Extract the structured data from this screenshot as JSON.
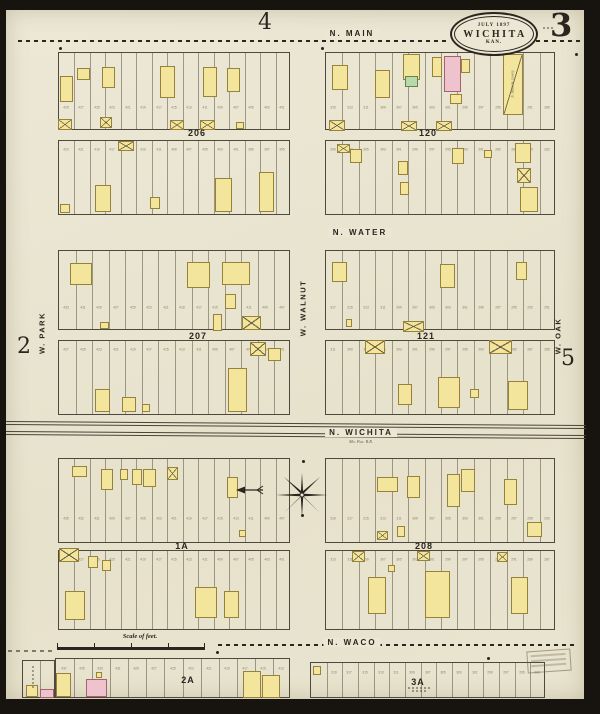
{
  "colors": {
    "paper": "#ebe7d4",
    "ink": "#2a251e",
    "frame_yellow": "#f3e59b",
    "frame_yellow_border": "#97823b",
    "brick_pink": "#eec3cd",
    "brick_pink_border": "#a2636f",
    "special_green": "#b9d9ab",
    "special_green_border": "#5f8452",
    "faint_number": "#8b8169"
  },
  "header": {
    "adjacent_top": "4",
    "sheet_number": "3",
    "title_date": "July 1897",
    "title_city": "WICHITA",
    "title_state": "KAN."
  },
  "margins": {
    "adjacent_left": "2",
    "adjacent_right": "5"
  },
  "streets": {
    "n_main": "N. MAIN",
    "n_water": "N. WATER",
    "n_wichita": "N. WICHITA",
    "n_waco": "N. WACO",
    "w_park": "W. PARK",
    "w_walnut": "W. WALNUT",
    "w_oak": "W. OAK"
  },
  "railroad": {
    "note": "Mo. Pac. R.R."
  },
  "scale": {
    "label": "Scale of feet."
  },
  "notes": {
    "livery": "N. Main St. Livery"
  },
  "blocks": [
    {
      "label": "206",
      "lx": 197,
      "ly": 128,
      "strips": [
        {
          "x": 58,
          "y": 52,
          "w": 232,
          "h": 78,
          "lots": 15,
          "ny": 0.72,
          "ns": 429,
          "b": [
            [
              60,
              76,
              13,
              26,
              "y",
              0
            ],
            [
              77,
              68,
              13,
              12,
              "y",
              0
            ],
            [
              102,
              67,
              13,
              21,
              "y",
              0
            ],
            [
              160,
              66,
              15,
              32,
              "y",
              0
            ],
            [
              203,
              67,
              14,
              30,
              "y",
              0
            ],
            [
              227,
              68,
              13,
              24,
              "y",
              0
            ],
            [
              58,
              119,
              14,
              11,
              "y",
              1
            ],
            [
              100,
              117,
              12,
              11,
              "y",
              1
            ],
            [
              170,
              120,
              14,
              10,
              "y",
              1
            ],
            [
              200,
              120,
              15,
              10,
              "y",
              1
            ],
            [
              236,
              122,
              8,
              7,
              "y",
              0
            ]
          ]
        },
        {
          "x": 58,
          "y": 140,
          "w": 232,
          "h": 75,
          "lots": 15,
          "ny": 0.13,
          "ns": 423,
          "b": [
            [
              118,
              141,
              16,
              10,
              "y",
              1
            ],
            [
              95,
              185,
              16,
              27,
              "y",
              0
            ],
            [
              150,
              197,
              10,
              12,
              "y",
              0
            ],
            [
              215,
              178,
              17,
              34,
              "y",
              0
            ],
            [
              259,
              172,
              15,
              40,
              "y",
              0
            ],
            [
              60,
              204,
              10,
              9,
              "y",
              0
            ]
          ]
        }
      ]
    },
    {
      "label": "120",
      "lx": 428,
      "ly": 128,
      "strips": [
        {
          "x": 325,
          "y": 52,
          "w": 230,
          "h": 78,
          "lots": 14,
          "ny": 0.72,
          "ns": 315,
          "b": [
            [
              332,
              65,
              16,
              25,
              "y",
              0
            ],
            [
              375,
              70,
              15,
              28,
              "y",
              0
            ],
            [
              403,
              54,
              17,
              26,
              "y",
              0
            ],
            [
              405,
              76,
              13,
              11,
              "g",
              0
            ],
            [
              432,
              57,
              10,
              20,
              "y",
              0
            ],
            [
              444,
              56,
              17,
              36,
              "p",
              0
            ],
            [
              461,
              59,
              9,
              14,
              "y",
              0
            ],
            [
              450,
              94,
              12,
              10,
              "y",
              0
            ],
            [
              503,
              54,
              20,
              61,
              "y",
              2
            ],
            [
              401,
              121,
              16,
              10,
              "y",
              1
            ],
            [
              436,
              121,
              16,
              10,
              "y",
              1
            ],
            [
              329,
              120,
              16,
              11,
              "y",
              1
            ]
          ]
        },
        {
          "x": 325,
          "y": 140,
          "w": 230,
          "h": 75,
          "lots": 14,
          "ny": 0.13,
          "ns": 309,
          "b": [
            [
              350,
              149,
              12,
              14,
              "y",
              0
            ],
            [
              398,
              161,
              10,
              14,
              "y",
              0
            ],
            [
              400,
              182,
              9,
              13,
              "y",
              0
            ],
            [
              452,
              148,
              12,
              16,
              "y",
              0
            ],
            [
              515,
              143,
              16,
              20,
              "y",
              0
            ],
            [
              517,
              168,
              14,
              15,
              "y",
              1
            ],
            [
              520,
              187,
              18,
              25,
              "y",
              0
            ],
            [
              484,
              150,
              8,
              8,
              "y",
              0
            ],
            [
              337,
              144,
              13,
              9,
              "y",
              1
            ]
          ]
        }
      ]
    },
    {
      "label": "207",
      "lx": 198,
      "ly": 331,
      "strips": [
        {
          "x": 58,
          "y": 250,
          "w": 232,
          "h": 80,
          "lots": 14,
          "ny": 0.72,
          "ns": 433,
          "b": [
            [
              70,
              263,
              22,
              22,
              "y",
              0
            ],
            [
              187,
              262,
              23,
              26,
              "y",
              0
            ],
            [
              222,
              262,
              28,
              23,
              "y",
              0
            ],
            [
              225,
              294,
              11,
              15,
              "y",
              0
            ],
            [
              100,
              322,
              9,
              7,
              "y",
              0
            ],
            [
              213,
              314,
              9,
              17,
              "y",
              0
            ],
            [
              242,
              316,
              19,
              14,
              "y",
              1
            ]
          ]
        },
        {
          "x": 58,
          "y": 340,
          "w": 232,
          "h": 75,
          "lots": 14,
          "ny": 0.13,
          "ns": 427,
          "b": [
            [
              95,
              389,
              15,
              23,
              "y",
              0
            ],
            [
              122,
              397,
              14,
              15,
              "y",
              0
            ],
            [
              228,
              368,
              19,
              44,
              "y",
              0
            ],
            [
              250,
              342,
              16,
              14,
              "y",
              1
            ],
            [
              268,
              348,
              13,
              13,
              "y",
              0
            ],
            [
              142,
              404,
              8,
              8,
              "y",
              0
            ]
          ]
        }
      ]
    },
    {
      "label": "121",
      "lx": 426,
      "ly": 331,
      "strips": [
        {
          "x": 325,
          "y": 250,
          "w": 230,
          "h": 80,
          "lots": 14,
          "ny": 0.72,
          "ns": 317,
          "b": [
            [
              332,
              262,
              15,
              20,
              "y",
              0
            ],
            [
              440,
              264,
              15,
              24,
              "y",
              0
            ],
            [
              516,
              262,
              11,
              18,
              "y",
              0
            ],
            [
              403,
              321,
              21,
              11,
              "y",
              1
            ],
            [
              346,
              319,
              6,
              8,
              "y",
              0
            ]
          ]
        },
        {
          "x": 325,
          "y": 340,
          "w": 230,
          "h": 75,
          "lots": 14,
          "ny": 0.13,
          "ns": 311,
          "b": [
            [
              365,
              340,
              20,
              14,
              "y",
              1
            ],
            [
              489,
              340,
              23,
              14,
              "y",
              1
            ],
            [
              398,
              384,
              14,
              21,
              "y",
              0
            ],
            [
              438,
              377,
              22,
              31,
              "y",
              0
            ],
            [
              508,
              381,
              20,
              29,
              "y",
              0
            ],
            [
              470,
              389,
              9,
              9,
              "y",
              0
            ]
          ]
        }
      ]
    },
    {
      "label": "1A",
      "lx": 182,
      "ly": 541,
      "strips": [
        {
          "x": 58,
          "y": 458,
          "w": 232,
          "h": 85,
          "lots": 15,
          "ny": 0.72,
          "ns": 435,
          "b": [
            [
              72,
              466,
              15,
              11,
              "y",
              0
            ],
            [
              101,
              469,
              12,
              21,
              "y",
              0
            ],
            [
              120,
              469,
              8,
              11,
              "y",
              0
            ],
            [
              132,
              469,
              10,
              16,
              "y",
              0
            ],
            [
              143,
              469,
              13,
              18,
              "y",
              0
            ],
            [
              167,
              467,
              11,
              13,
              "y",
              1
            ],
            [
              227,
              477,
              11,
              21,
              "y",
              0
            ],
            [
              239,
              530,
              7,
              7,
              "y",
              0
            ]
          ]
        },
        {
          "x": 58,
          "y": 550,
          "w": 232,
          "h": 80,
          "lots": 15,
          "ny": 0.13,
          "ns": 429,
          "b": [
            [
              59,
              548,
              20,
              14,
              "y",
              1
            ],
            [
              88,
              556,
              10,
              12,
              "y",
              0
            ],
            [
              102,
              560,
              9,
              11,
              "y",
              0
            ],
            [
              65,
              591,
              20,
              29,
              "y",
              0
            ],
            [
              195,
              587,
              22,
              31,
              "y",
              0
            ],
            [
              224,
              591,
              15,
              27,
              "y",
              0
            ]
          ]
        }
      ]
    },
    {
      "label": "208",
      "lx": 424,
      "ly": 541,
      "strips": [
        {
          "x": 325,
          "y": 458,
          "w": 230,
          "h": 85,
          "lots": 14,
          "ny": 0.72,
          "ns": 319,
          "b": [
            [
              377,
              477,
              21,
              15,
              "y",
              0
            ],
            [
              407,
              476,
              13,
              22,
              "y",
              0
            ],
            [
              447,
              474,
              13,
              33,
              "y",
              0
            ],
            [
              461,
              469,
              14,
              23,
              "y",
              0
            ],
            [
              504,
              479,
              13,
              26,
              "y",
              0
            ],
            [
              527,
              522,
              15,
              15,
              "y",
              0
            ],
            [
              377,
              531,
              11,
              9,
              "y",
              1
            ],
            [
              397,
              526,
              8,
              11,
              "y",
              0
            ]
          ]
        },
        {
          "x": 325,
          "y": 550,
          "w": 230,
          "h": 80,
          "lots": 14,
          "ny": 0.13,
          "ns": 313,
          "b": [
            [
              352,
              551,
              13,
              11,
              "y",
              1
            ],
            [
              417,
              551,
              13,
              10,
              "y",
              1
            ],
            [
              497,
              552,
              11,
              10,
              "y",
              1
            ],
            [
              368,
              577,
              18,
              37,
              "y",
              0
            ],
            [
              425,
              571,
              25,
              47,
              "y",
              0
            ],
            [
              511,
              577,
              17,
              37,
              "y",
              0
            ],
            [
              388,
              565,
              7,
              7,
              "y",
              0
            ]
          ]
        }
      ]
    },
    {
      "label": "2A",
      "lx": 188,
      "ly": 675,
      "strips": [
        {
          "x": 55,
          "y": 658,
          "w": 235,
          "h": 40,
          "lots": 13,
          "ny": 0.28,
          "ns": 437,
          "b": [
            [
              56,
              673,
              15,
              24,
              "y",
              0
            ],
            [
              86,
              679,
              21,
              18,
              "p",
              0
            ],
            [
              243,
              671,
              18,
              27,
              "y",
              0
            ],
            [
              262,
              675,
              18,
              23,
              "y",
              0
            ],
            [
              96,
              672,
              6,
              6,
              "y",
              0
            ]
          ]
        },
        {
          "x": 22,
          "y": 660,
          "w": 33,
          "h": 38,
          "lots": 2,
          "b": [
            [
              26,
              685,
              12,
              12,
              "y",
              0
            ],
            [
              40,
              689,
              14,
              9,
              "p",
              0
            ]
          ]
        }
      ]
    },
    {
      "label": "3A",
      "lx": 418,
      "ly": 677,
      "strips": [
        {
          "x": 310,
          "y": 662,
          "w": 235,
          "h": 36,
          "lots": 15,
          "ny": 0.3,
          "ns": 321,
          "b": [
            [
              313,
              666,
              8,
              9,
              "y",
              0
            ]
          ]
        }
      ]
    }
  ],
  "dots": [
    [
      321,
      47
    ],
    [
      575,
      53
    ],
    [
      59,
      47
    ],
    [
      216,
      651
    ],
    [
      487,
      657
    ],
    [
      302,
      460
    ],
    [
      301,
      514
    ]
  ]
}
